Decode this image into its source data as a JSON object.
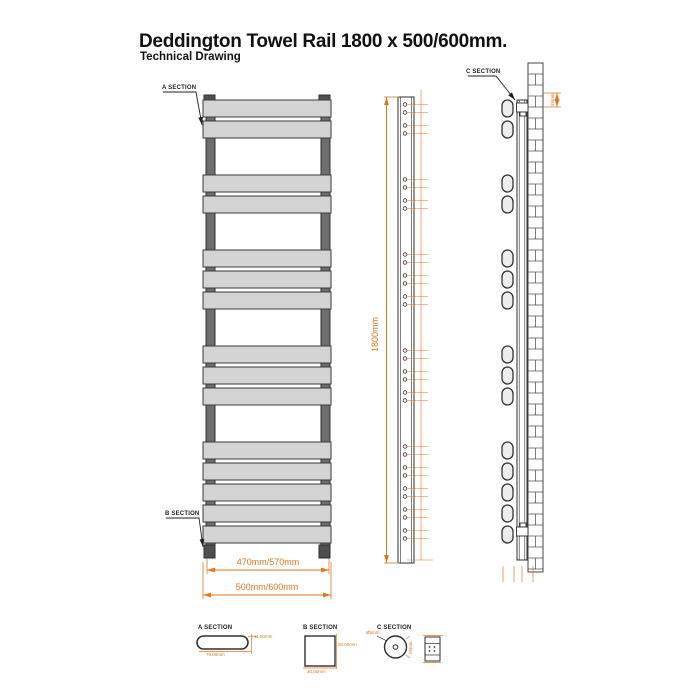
{
  "title": "Deddington Towel Rail 1800 x 500/600mm.",
  "subtitle": "Technical Drawing",
  "colors": {
    "line": "#2f2f2f",
    "panel_fill": "#d4d4d4",
    "tube_fill": "#6e6e6e",
    "tab_fill": "#4f4f4f",
    "dim": "#e0741f"
  },
  "front_view": {
    "section_a_label": "A SECTION",
    "section_b_label": "B SECTION",
    "panel_groups": [
      2,
      2,
      3,
      3,
      5
    ],
    "dim_inner_width": "470mm/570mm",
    "dim_outer_width": "500mm/600mm"
  },
  "side_profile_view": {
    "dim_height": "1800mm",
    "holes_per_panel": 2
  },
  "wall_mount_view": {
    "section_c_label": "C SECTION",
    "bracket_dim": "55mm"
  },
  "section_details": {
    "a": {
      "label": "A SECTION",
      "thickness": "11.00mm",
      "width": "70.00mm"
    },
    "b": {
      "label": "B SECTION",
      "height": "30.00mm",
      "width": "30.00mm"
    },
    "c": {
      "label": "C SECTION",
      "hole_dia": "Ø5mm",
      "outer_dia": "55mm"
    }
  }
}
